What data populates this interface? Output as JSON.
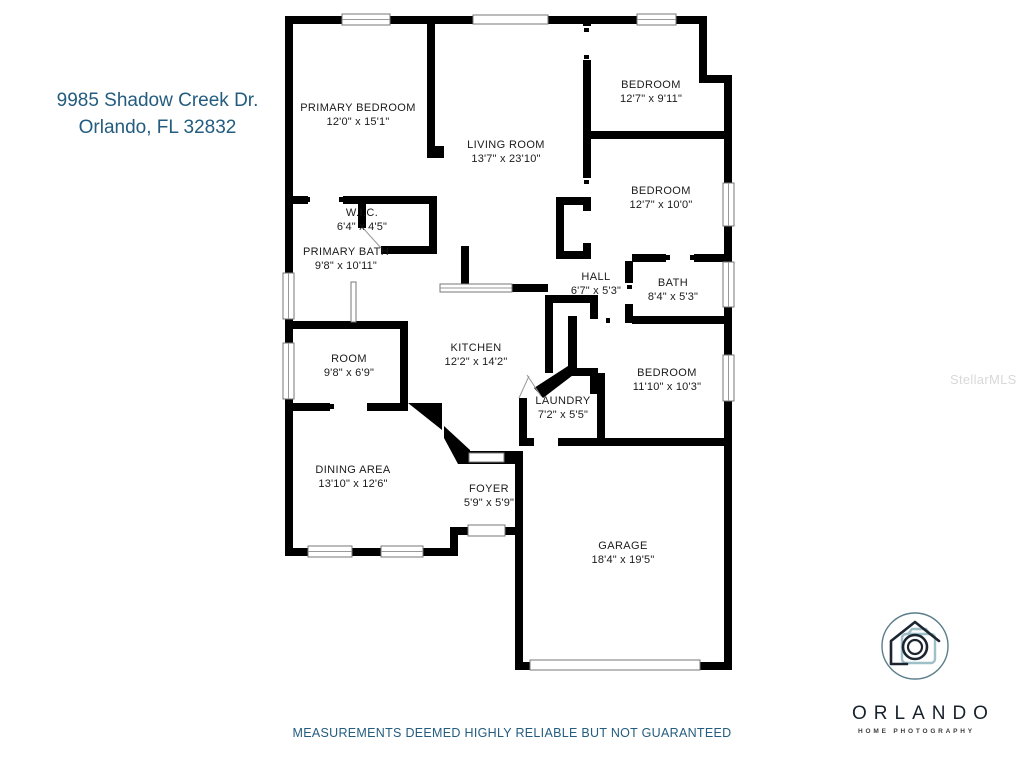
{
  "address": {
    "line1": "9985 Shadow Creek Dr.",
    "line2": "Orlando, FL 32832"
  },
  "rooms": [
    {
      "name": "PRIMARY BEDROOM",
      "dims": "12'0\" x 15'1\""
    },
    {
      "name": "LIVING ROOM",
      "dims": "13'7\" x 23'10\""
    },
    {
      "name": "BEDROOM",
      "dims": "12'7\" x 9'11\""
    },
    {
      "name": "BEDROOM",
      "dims": "12'7\" x 10'0\""
    },
    {
      "name": "W.I.C.",
      "dims": "6'4\" x 4'5\""
    },
    {
      "name": "PRIMARY BATH",
      "dims": "9'8\" x 10'11\""
    },
    {
      "name": "HALL",
      "dims": "6'7\" x 5'3\""
    },
    {
      "name": "BATH",
      "dims": "8'4\" x 5'3\""
    },
    {
      "name": "ROOM",
      "dims": "9'8\" x 6'9\""
    },
    {
      "name": "KITCHEN",
      "dims": "12'2\" x 14'2\""
    },
    {
      "name": "LAUNDRY",
      "dims": "7'2\" x 5'5\""
    },
    {
      "name": "BEDROOM",
      "dims": "11'10\" x 10'3\""
    },
    {
      "name": "DINING AREA",
      "dims": "13'10\" x 12'6\""
    },
    {
      "name": "FOYER",
      "dims": "5'9\" x 5'9\""
    },
    {
      "name": "GARAGE",
      "dims": "18'4\" x 19'5\""
    }
  ],
  "watermark": "StellarMLS",
  "logo": {
    "brand": "ORLANDO",
    "tagline": "HOME PHOTOGRAPHY"
  },
  "footer": {
    "disclaimer": "MEASUREMENTS DEEMED HIGHLY RELIABLE BUT NOT GUARANTEED"
  },
  "colors": {
    "accent_blue": "#235c7f",
    "wall_black": "#000000",
    "camera_teal": "#9fc0c8",
    "watermark_gray": "#cccccc"
  }
}
